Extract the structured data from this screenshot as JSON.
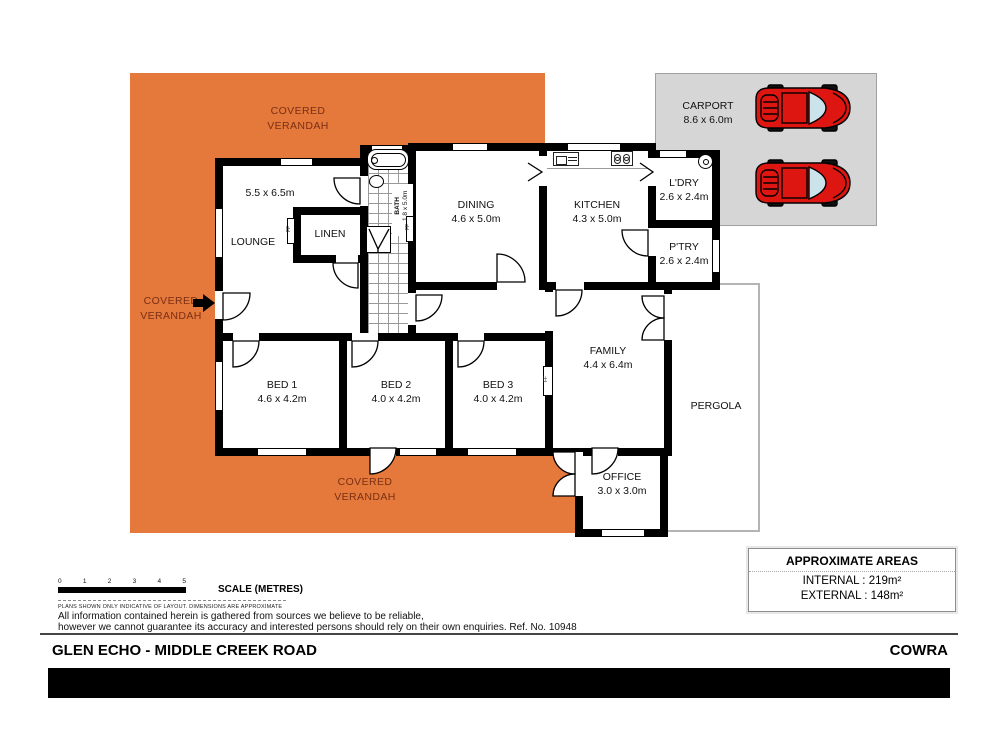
{
  "plan": {
    "verandah_label": {
      "line1": "COVERED",
      "line2": "VERANDAH"
    },
    "rooms": {
      "lounge": {
        "name": "LOUNGE",
        "dims": "5.5 x 6.5m"
      },
      "linen": {
        "name": "LINEN"
      },
      "bath": {
        "name": "BATH",
        "dims": "1.8 x 5.0m"
      },
      "dining": {
        "name": "DINING",
        "dims": "4.6 x 5.0m"
      },
      "kitchen": {
        "name": "KITCHEN",
        "dims": "4.3 x 5.0m"
      },
      "laundry": {
        "name": "L'DRY",
        "dims": "2.6 x 2.4m"
      },
      "pantry": {
        "name": "P'TRY",
        "dims": "2.6 x 2.4m"
      },
      "family": {
        "name": "FAMILY",
        "dims": "4.4 x 6.4m"
      },
      "bed1": {
        "name": "BED 1",
        "dims": "4.6 x 4.2m"
      },
      "bed2": {
        "name": "BED 2",
        "dims": "4.0 x 4.2m"
      },
      "bed3": {
        "name": "BED 3",
        "dims": "4.0 x 4.2m"
      },
      "office": {
        "name": "OFFICE",
        "dims": "3.0 x 3.0m"
      },
      "pergola": {
        "name": "PERGOLA"
      },
      "carport": {
        "name": "CARPORT",
        "dims": "8.6 x 6.0m"
      }
    },
    "ff_marker": "FF"
  },
  "scale_bar": {
    "ticks": [
      "0",
      "1",
      "2",
      "3",
      "4",
      "5"
    ],
    "label": "SCALE (METRES)"
  },
  "notes": {
    "fine_print": "PLANS SHOWN ONLY INDICATIVE OF LAYOUT.  DIMENSIONS ARE APPROXIMATE",
    "disclaimer1": "All information contained herein is gathered from sources we believe to be reliable,",
    "disclaimer2": "however we cannot guarantee its accuracy and interested persons should rely on their own enquiries. Ref. No. 10948"
  },
  "areas_box": {
    "title": "APPROXIMATE AREAS",
    "rows": [
      {
        "text": "INTERNAL  : 219m²"
      },
      {
        "text": "EXTERNAL : 148m²"
      }
    ]
  },
  "footer": {
    "property_name": "GLEN ECHO - MIDDLE CREEK ROAD",
    "locality": "COWRA"
  },
  "colors": {
    "verandah": "#E5793B",
    "verandah_text": "#7A2F15",
    "carport_bg": "#D6D6D6",
    "carport_border": "#A0A0A0",
    "car_red": "#DE1612",
    "wall": "#000000",
    "pergola_border": "#B4B4B4"
  }
}
